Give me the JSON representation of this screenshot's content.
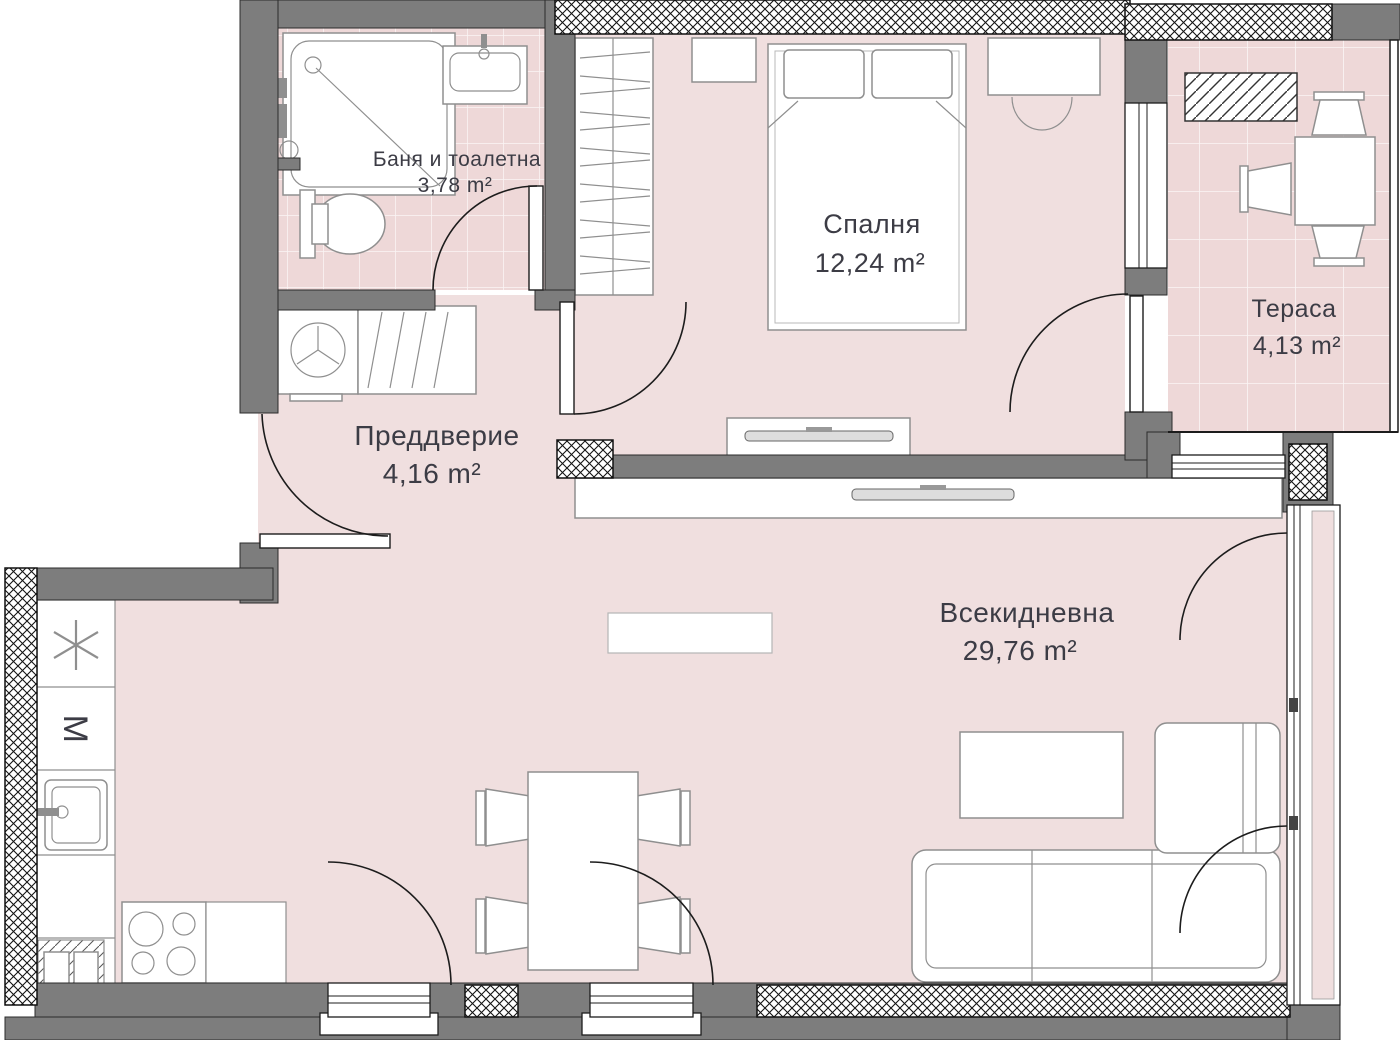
{
  "plan_type": "apartment-floor-plan",
  "rooms": {
    "bathroom": {
      "name": "Баня и тоалетна",
      "area": "3,78 m²"
    },
    "bedroom": {
      "name": "Спалня",
      "area": "12,24 m²"
    },
    "terrace": {
      "name": "Тераса",
      "area": "4,13 m²"
    },
    "vestibule": {
      "name": "Преддверие",
      "area": "4,16 m²"
    },
    "living": {
      "name": "Всекидневна",
      "area": "29,76 m²"
    }
  },
  "kitchen": {
    "appliance_label": "M"
  },
  "colors": {
    "floor_pink": "#f0dfdf",
    "tile_pink": "#eed8d8",
    "wall_gray": "#7d7d7d",
    "outline": "#1c1c1c",
    "furniture_line": "#8f8f8f",
    "text": "#3c3c45"
  }
}
